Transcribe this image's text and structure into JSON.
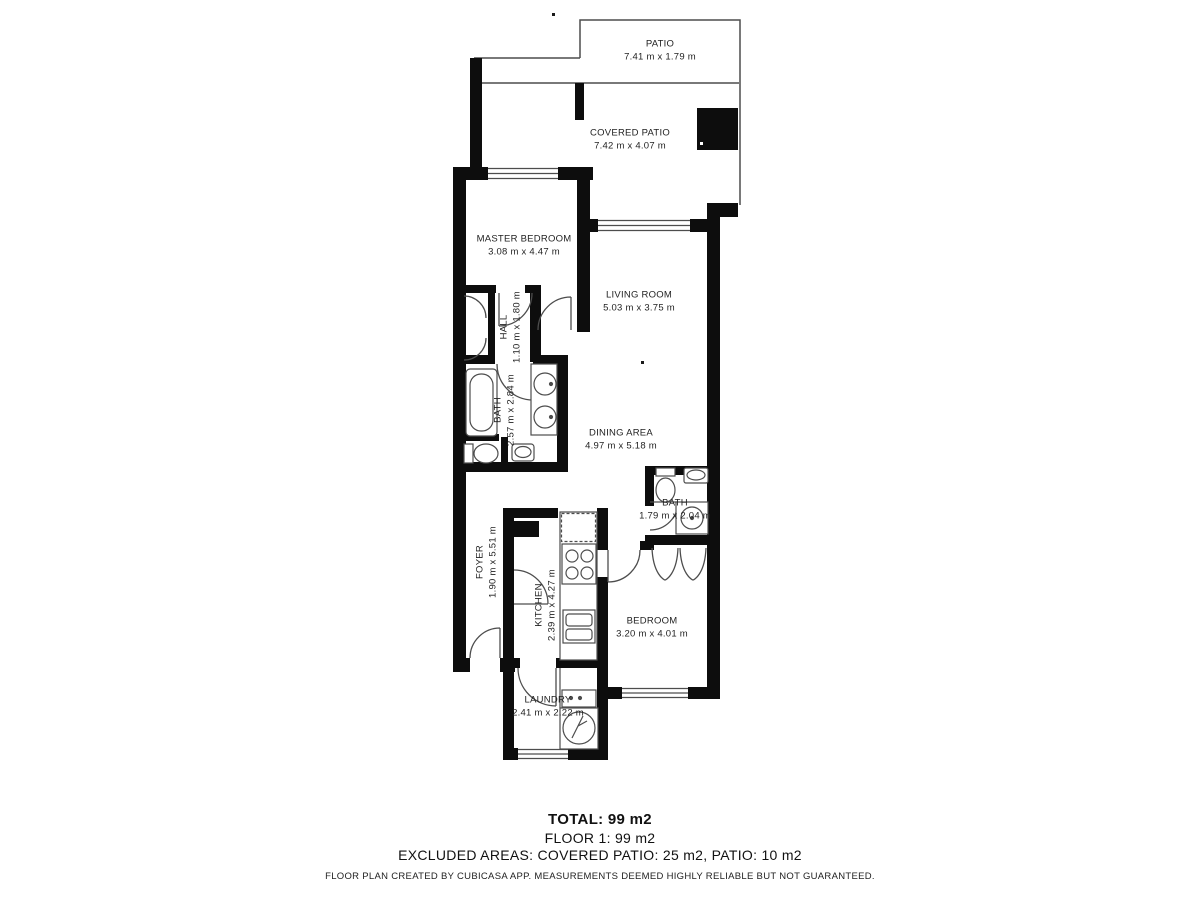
{
  "floorplan": {
    "rooms": {
      "patio": {
        "name": "PATIO",
        "dims": "7.41 m x 1.79 m"
      },
      "covered_patio": {
        "name": "COVERED PATIO",
        "dims": "7.42 m x 4.07 m"
      },
      "master_bedroom": {
        "name": "MASTER BEDROOM",
        "dims": "3.08 m x 4.47 m"
      },
      "living_room": {
        "name": "LIVING ROOM",
        "dims": "5.03 m x 3.75 m"
      },
      "hall": {
        "name": "HALL",
        "dims": "1.10 m x 1.80 m"
      },
      "bath_master": {
        "name": "BATH",
        "dims": "2.57 m x 2.84 m"
      },
      "dining_area": {
        "name": "DINING AREA",
        "dims": "4.97 m x 5.18 m"
      },
      "bath_2": {
        "name": "BATH",
        "dims": "1.79 m x 2.04 m"
      },
      "foyer": {
        "name": "FOYER",
        "dims": "1.90 m x 5.51 m"
      },
      "kitchen": {
        "name": "KITCHEN",
        "dims": "2.39 m x 4.27 m"
      },
      "bedroom": {
        "name": "BEDROOM",
        "dims": "3.20 m x 4.01 m"
      },
      "laundry": {
        "name": "LAUNDRY",
        "dims": "2.41 m x 2.22 m"
      }
    },
    "summary": {
      "total": "TOTAL: 99 m2",
      "floor": "FLOOR 1: 99 m2",
      "excluded": "EXCLUDED AREAS: COVERED PATIO: 25 m2, PATIO: 10 m2",
      "disclaimer": "FLOOR PLAN CREATED BY CUBICASA APP. MEASUREMENTS DEEMED HIGHLY RELIABLE BUT NOT GUARANTEED."
    },
    "colors": {
      "wall": "#0d0d0d",
      "line": "#4d4d4d",
      "text": "#1f1f1f",
      "background": "#ffffff"
    }
  }
}
